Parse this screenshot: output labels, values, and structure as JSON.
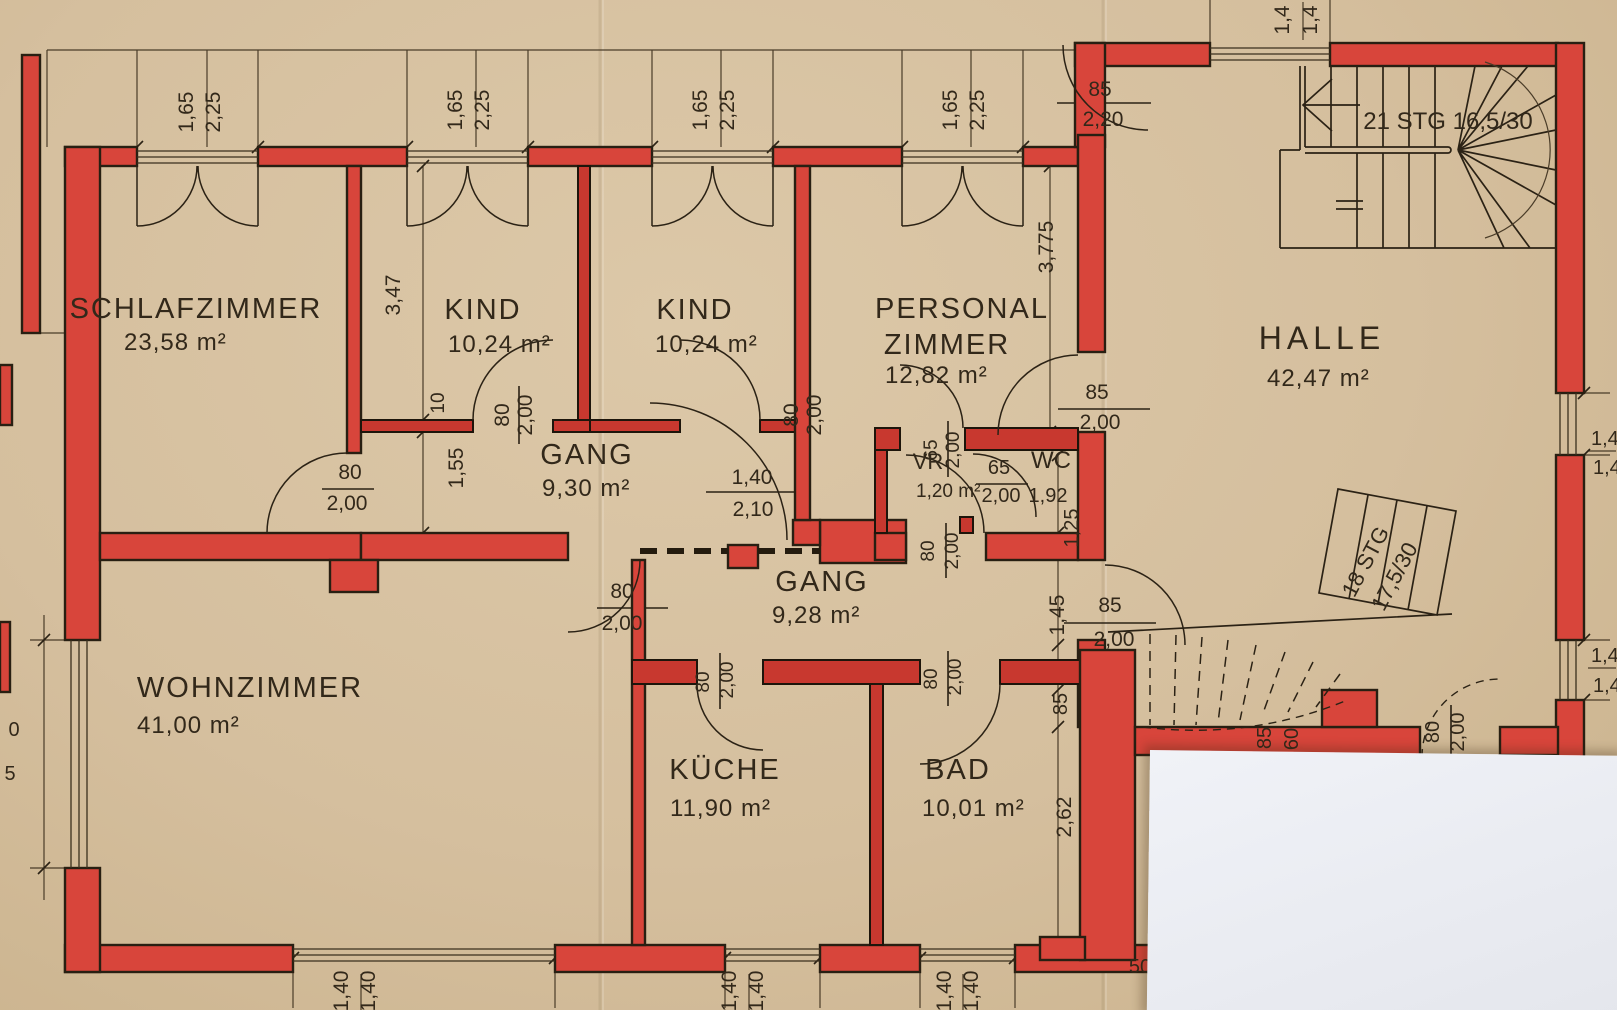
{
  "document": {
    "type": "architectural floor plan, hand drawn, walls highlighted in red on beige paper"
  },
  "colors": {
    "paper": "#d5bf9e",
    "wall_red": "#d8453b",
    "ink": "#32281a",
    "overlay_paper": "#eef0f5"
  },
  "rooms": [
    {
      "name": "SCHLAFZIMMER",
      "area": "23,58 m²"
    },
    {
      "name": "KIND",
      "area": "10,24 m²"
    },
    {
      "name": "KIND",
      "area": "10,24 m²"
    },
    {
      "name": "PERSONAL",
      "name2": "ZIMMER",
      "area": "12,82 m²"
    },
    {
      "name": "HALLE",
      "area": "42,47 m²"
    },
    {
      "name": "GANG",
      "area": "9,30 m²"
    },
    {
      "name": "GANG",
      "area": "9,28 m²"
    },
    {
      "name": "WOHNZIMMER",
      "area": "41,00 m²"
    },
    {
      "name": "KÜCHE",
      "area": "11,90 m²"
    },
    {
      "name": "BAD",
      "area": "10,01 m²"
    },
    {
      "name": "VR",
      "area": "1,20 m²"
    },
    {
      "name": "WC",
      "area": "1,92"
    }
  ],
  "stairs": [
    {
      "label": "21 STG 16,5/30"
    },
    {
      "label": "18 STG"
    },
    {
      "label": "17,5/30"
    }
  ],
  "dims": [
    {
      "v": "1,65",
      "x": 193,
      "y": 112,
      "r": -90
    },
    {
      "v": "2,25",
      "x": 220,
      "y": 112,
      "r": -90
    },
    {
      "v": "1,65",
      "x": 462,
      "y": 110,
      "r": -90
    },
    {
      "v": "2,25",
      "x": 489,
      "y": 110,
      "r": -90
    },
    {
      "v": "1,65",
      "x": 707,
      "y": 110,
      "r": -90
    },
    {
      "v": "2,25",
      "x": 734,
      "y": 110,
      "r": -90
    },
    {
      "v": "1,65",
      "x": 957,
      "y": 110,
      "r": -90
    },
    {
      "v": "2,25",
      "x": 984,
      "y": 110,
      "r": -90
    },
    {
      "v": "1,4",
      "x": 1289,
      "y": 20,
      "r": -90
    },
    {
      "v": "1,4",
      "x": 1317,
      "y": 20,
      "r": -90
    },
    {
      "v": "85",
      "x": 1100,
      "y": 96
    },
    {
      "v": "2,20",
      "x": 1103,
      "y": 126
    },
    {
      "v": "3,47",
      "x": 400,
      "y": 295,
      "r": -90
    },
    {
      "v": "10",
      "x": 444,
      "y": 403,
      "r": -90,
      "s": 19
    },
    {
      "v": "1,55",
      "x": 463,
      "y": 468,
      "r": -90
    },
    {
      "v": "80",
      "x": 509,
      "y": 415,
      "r": -90
    },
    {
      "v": "2,00",
      "x": 532,
      "y": 415,
      "r": -90
    },
    {
      "v": "80",
      "x": 798,
      "y": 415,
      "r": -90
    },
    {
      "v": "2,00",
      "x": 821,
      "y": 415,
      "r": -90
    },
    {
      "v": "80",
      "x": 350,
      "y": 479
    },
    {
      "v": "2,00",
      "x": 347,
      "y": 510
    },
    {
      "v": "1,40",
      "x": 752,
      "y": 484
    },
    {
      "v": "2,10",
      "x": 753,
      "y": 516
    },
    {
      "v": "3,775",
      "x": 1053,
      "y": 247,
      "r": -90
    },
    {
      "v": "85",
      "x": 1097,
      "y": 399
    },
    {
      "v": "2,00",
      "x": 1100,
      "y": 429
    },
    {
      "v": "65",
      "x": 937,
      "y": 450,
      "r": -90,
      "s": 19
    },
    {
      "v": "2,00",
      "x": 959,
      "y": 450,
      "r": -90,
      "s": 19
    },
    {
      "v": "65",
      "x": 999,
      "y": 474,
      "s": 20
    },
    {
      "v": "2,00",
      "x": 1001,
      "y": 502,
      "s": 20
    },
    {
      "v": "1,25",
      "x": 1078,
      "y": 528,
      "r": -90,
      "s": 20
    },
    {
      "v": "80",
      "x": 934,
      "y": 551,
      "r": -90,
      "s": 19
    },
    {
      "v": "2,00",
      "x": 958,
      "y": 551,
      "r": -90,
      "s": 19
    },
    {
      "v": "80",
      "x": 622,
      "y": 598
    },
    {
      "v": "2,00",
      "x": 622,
      "y": 630
    },
    {
      "v": "85",
      "x": 1110,
      "y": 612
    },
    {
      "v": "2,00",
      "x": 1114,
      "y": 646
    },
    {
      "v": "1,45",
      "x": 1064,
      "y": 615,
      "r": -90
    },
    {
      "v": "80",
      "x": 709,
      "y": 682,
      "r": -90,
      "s": 19
    },
    {
      "v": "2,00",
      "x": 733,
      "y": 680,
      "r": -90,
      "s": 19
    },
    {
      "v": "80",
      "x": 937,
      "y": 679,
      "r": -90,
      "s": 19
    },
    {
      "v": "2,00",
      "x": 961,
      "y": 677,
      "r": -90,
      "s": 19
    },
    {
      "v": "85",
      "x": 1067,
      "y": 704,
      "r": -90,
      "s": 20
    },
    {
      "v": "2,62",
      "x": 1071,
      "y": 817,
      "r": -90
    },
    {
      "v": "85",
      "x": 1271,
      "y": 738,
      "r": -90,
      "s": 20
    },
    {
      "v": "60",
      "x": 1298,
      "y": 739,
      "r": -90,
      "s": 20
    },
    {
      "v": "80",
      "x": 1439,
      "y": 732,
      "r": -90,
      "s": 20
    },
    {
      "v": "2,00",
      "x": 1464,
      "y": 732,
      "r": -90,
      "s": 20
    },
    {
      "v": "50",
      "x": 1140,
      "y": 973,
      "s": 20
    },
    {
      "v": "1,40",
      "x": 348,
      "y": 991,
      "r": -90
    },
    {
      "v": "1,40",
      "x": 375,
      "y": 991,
      "r": -90
    },
    {
      "v": "1,40",
      "x": 736,
      "y": 991,
      "r": -90
    },
    {
      "v": "1,40",
      "x": 763,
      "y": 991,
      "r": -90
    },
    {
      "v": "1,40",
      "x": 951,
      "y": 991,
      "r": -90
    },
    {
      "v": "1,40",
      "x": 978,
      "y": 991,
      "r": -90
    },
    {
      "v": "0",
      "x": 14,
      "y": 736,
      "s": 20
    },
    {
      "v": "5",
      "x": 10,
      "y": 780,
      "s": 20
    },
    {
      "v": "1,4",
      "x": 1591,
      "y": 445,
      "s": 20,
      "a": "s"
    },
    {
      "v": "1,4",
      "x": 1593,
      "y": 474,
      "s": 20,
      "a": "s"
    },
    {
      "v": "1,4",
      "x": 1591,
      "y": 662,
      "s": 20,
      "a": "s"
    },
    {
      "v": "1,4",
      "x": 1593,
      "y": 692,
      "s": 20,
      "a": "s"
    }
  ]
}
